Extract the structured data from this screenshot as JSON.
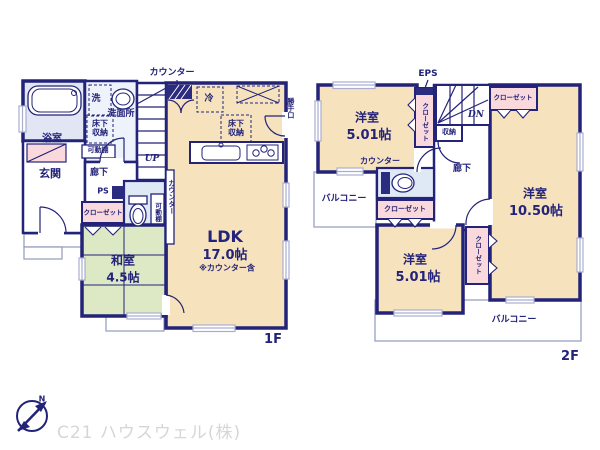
{
  "floor1": {
    "floor_label": "1F",
    "ldk": {
      "name": "LDK",
      "size": "17.0帖",
      "note": "※カウンター含"
    },
    "washitsu": {
      "name": "和室",
      "size": "4.5帖"
    },
    "genkan": "玄関",
    "bathroom": "浴室",
    "washroom": "洗面所",
    "hallway": "廊下",
    "closet": "クローゼット",
    "counter_top": "カウンター",
    "counter_side": "カウンター",
    "washer": "洗",
    "underfloor_washroom": "床下\n収納",
    "underfloor_kitchen": "床下\n収納",
    "shelf_washroom": "可動棚",
    "shelf_toilet": "可動棚",
    "pipe_space": "PS",
    "stairs_up": "UP",
    "fridge": "冷",
    "back_door": "勝手口"
  },
  "floor2": {
    "floor_label": "2F",
    "bedroom_a": {
      "name": "洋室",
      "size": "5.01帖"
    },
    "bedroom_b": {
      "name": "洋室",
      "size": "5.01帖"
    },
    "bedroom_c": {
      "name": "洋室",
      "size": "10.50帖"
    },
    "hallway": "廊下",
    "balcony_left": "バルコニー",
    "balcony_bottom": "バルコニー",
    "closet_a": "クローゼット",
    "closet_b": "クローゼット",
    "closet_c": "クローゼット",
    "closet_d": "クローゼット",
    "storage": "収納",
    "eps": "EPS",
    "stairs_down": "DN",
    "counter": "カウンター"
  },
  "branding": {
    "company": "C21 ハウスウェル(株)",
    "north_label": "N"
  },
  "colors": {
    "wall": "#23237a",
    "room": "#f6e3bd",
    "tatami": "#dde9c5",
    "closet": "#f9d9dc",
    "bath": "#e2e6f4",
    "toilet": "#dfe9f6",
    "text": "#23237a",
    "watermark": "#d6d6d6"
  }
}
